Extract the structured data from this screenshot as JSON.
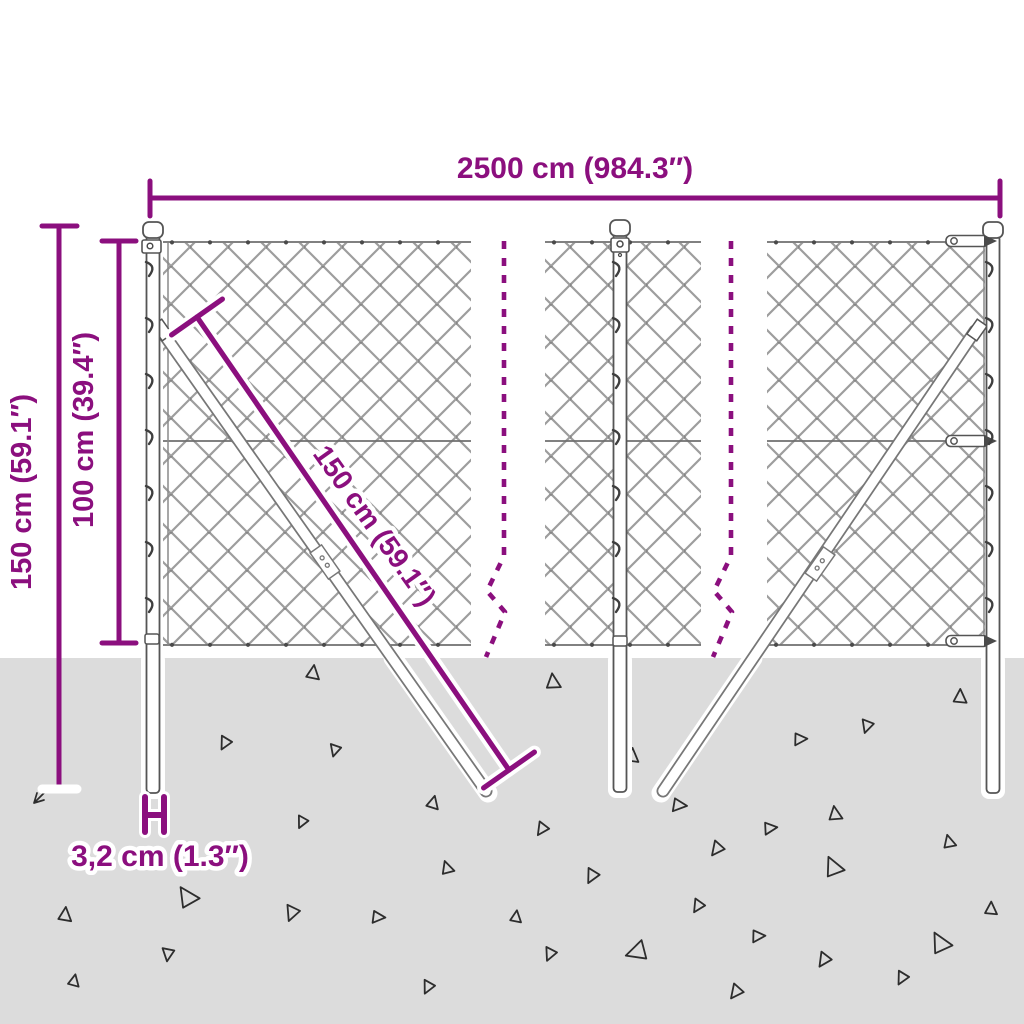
{
  "colors": {
    "accent": "#8b0f7e",
    "ground": "#dcdcdc",
    "mesh": "#9d9d9d",
    "wire": "#6f6f6f",
    "hardware": "#4a4a4a",
    "post_stroke": "#555555",
    "triangle": "#2d2d2d"
  },
  "annotations": {
    "total_width": "2500 cm (984.3″)",
    "total_height": "150 cm (59.1″)",
    "mesh_height": "100 cm (39.4″)",
    "brace_length": "150 cm (59.1″)",
    "post_diameter": "3,2 cm (1.3″)"
  },
  "triangles": [
    [
      313,
      673,
      13,
      8
    ],
    [
      553,
      682,
      14,
      -6
    ],
    [
      960,
      697,
      13,
      2
    ],
    [
      867,
      726,
      12,
      198
    ],
    [
      800,
      739,
      12,
      88
    ],
    [
      225,
      743,
      12,
      208
    ],
    [
      335,
      750,
      11,
      196
    ],
    [
      632,
      756,
      13,
      4
    ],
    [
      433,
      803,
      12,
      14
    ],
    [
      679,
      805,
      13,
      96
    ],
    [
      302,
      822,
      11,
      206
    ],
    [
      542,
      829,
      12,
      214
    ],
    [
      770,
      828,
      12,
      84
    ],
    [
      835,
      814,
      13,
      -8
    ],
    [
      717,
      849,
      13,
      218
    ],
    [
      949,
      842,
      12,
      -14
    ],
    [
      833,
      867,
      18,
      -24
    ],
    [
      592,
      876,
      13,
      208
    ],
    [
      447,
      868,
      12,
      -18
    ],
    [
      187,
      897,
      19,
      -33
    ],
    [
      65,
      915,
      13,
      6
    ],
    [
      292,
      913,
      14,
      202
    ],
    [
      378,
      917,
      12,
      94
    ],
    [
      698,
      906,
      12,
      212
    ],
    [
      516,
      917,
      11,
      8
    ],
    [
      991,
      909,
      12,
      2
    ],
    [
      758,
      936,
      12,
      88
    ],
    [
      550,
      954,
      12,
      204
    ],
    [
      637,
      952,
      19,
      252
    ],
    [
      824,
      960,
      13,
      214
    ],
    [
      940,
      943,
      19,
      -28
    ],
    [
      902,
      978,
      12,
      208
    ],
    [
      736,
      992,
      13,
      218
    ],
    [
      168,
      954,
      12,
      188
    ],
    [
      74,
      981,
      11,
      12
    ],
    [
      428,
      987,
      12,
      206
    ]
  ]
}
